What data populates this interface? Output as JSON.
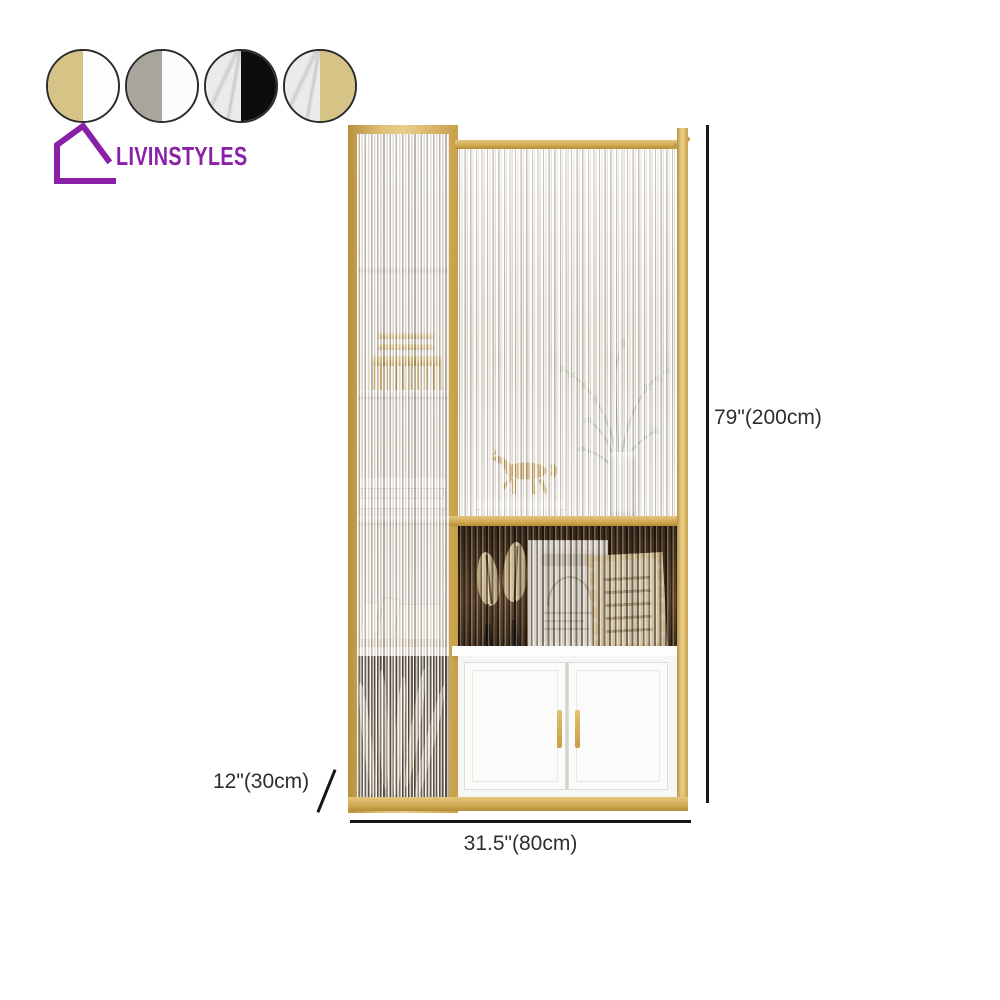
{
  "brand": {
    "name": "LIVINSTYLES",
    "color": "#8a1fa8"
  },
  "swatches": [
    {
      "name": "gold-white",
      "left": "#d6c386",
      "right": "#fdfdfd"
    },
    {
      "name": "grey-white",
      "left": "#a9a49c",
      "right": "#fcfcfc"
    },
    {
      "name": "marble-black",
      "left": "#ebebe9",
      "right": "#0d0d0d"
    },
    {
      "name": "marble-gold",
      "left": "#ebebe9",
      "right": "#d6c386"
    }
  ],
  "dimensions": {
    "height_label": "79\"(200cm)",
    "width_label": "31.5\"(80cm)",
    "depth_label": "12\"(30cm)"
  },
  "product": {
    "frame_color": "#cda952",
    "cabinet_color": "#fbfbfa",
    "glass_type": "reeded-glass",
    "decor_items": [
      "gold-horse-figurine",
      "branch-vase",
      "gold-lantern",
      "stacked-books",
      "feather-ornaments",
      "sketch-picture-frame",
      "fringed-cushion",
      "pampas-grass"
    ]
  },
  "annotation": {
    "line_color": "#161616",
    "text_color": "#2e2e2e"
  }
}
